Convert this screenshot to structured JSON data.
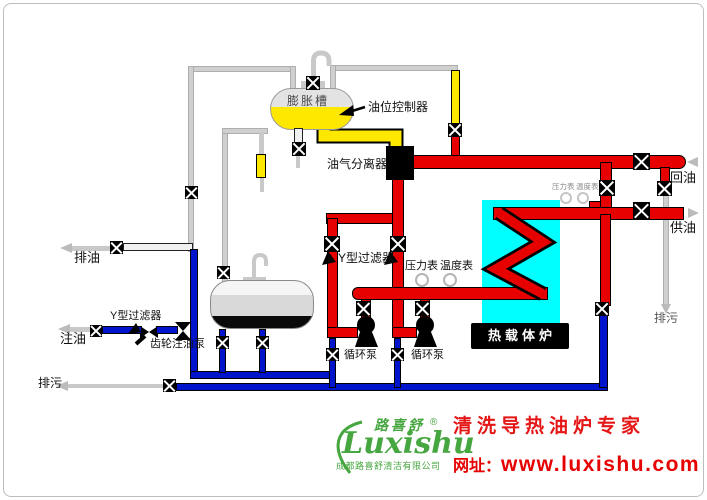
{
  "diagram": {
    "labels": {
      "expansion_tank": "膨胀槽",
      "oil_level_controller": "油位控制器",
      "oil_gas_separator": "油气分离器",
      "y_filter_main": "Y型过滤器",
      "y_filter_fill": "Y型过滤器",
      "pressure_gauge": "压力表",
      "temperature_gauge": "温度表",
      "pressure_gauge_small": "压力表",
      "temperature_gauge_small": "温度表",
      "circulation_pump_1": "循环泵",
      "circulation_pump_2": "循环泵",
      "gear_fill_pump": "齿轮注油泵",
      "heat_carrier_furnace": "热载体炉",
      "drain_oil": "排油",
      "fill_oil": "注油",
      "blowdown_left": "排污",
      "blowdown_right": "排污",
      "return_oil": "回油",
      "supply_oil": "供油"
    },
    "footer": {
      "brand_cn": "路喜舒",
      "registered": "®",
      "brand_en": "Luxishu",
      "company": "成都路喜舒清洁有限公司",
      "slogan": "清洗导热油炉专家",
      "site_label": "网址：",
      "site_url": "www.luxishu.com"
    },
    "colors": {
      "hot_pipe": "#e60000",
      "cold_pipe": "#0014cc",
      "oil_yellow": "#ffe800",
      "empty_pipe": "#cfcfcf",
      "furnace_bath": "#00ffff",
      "brand_green": "#46a63f",
      "slogan_red": "#e51616"
    }
  }
}
